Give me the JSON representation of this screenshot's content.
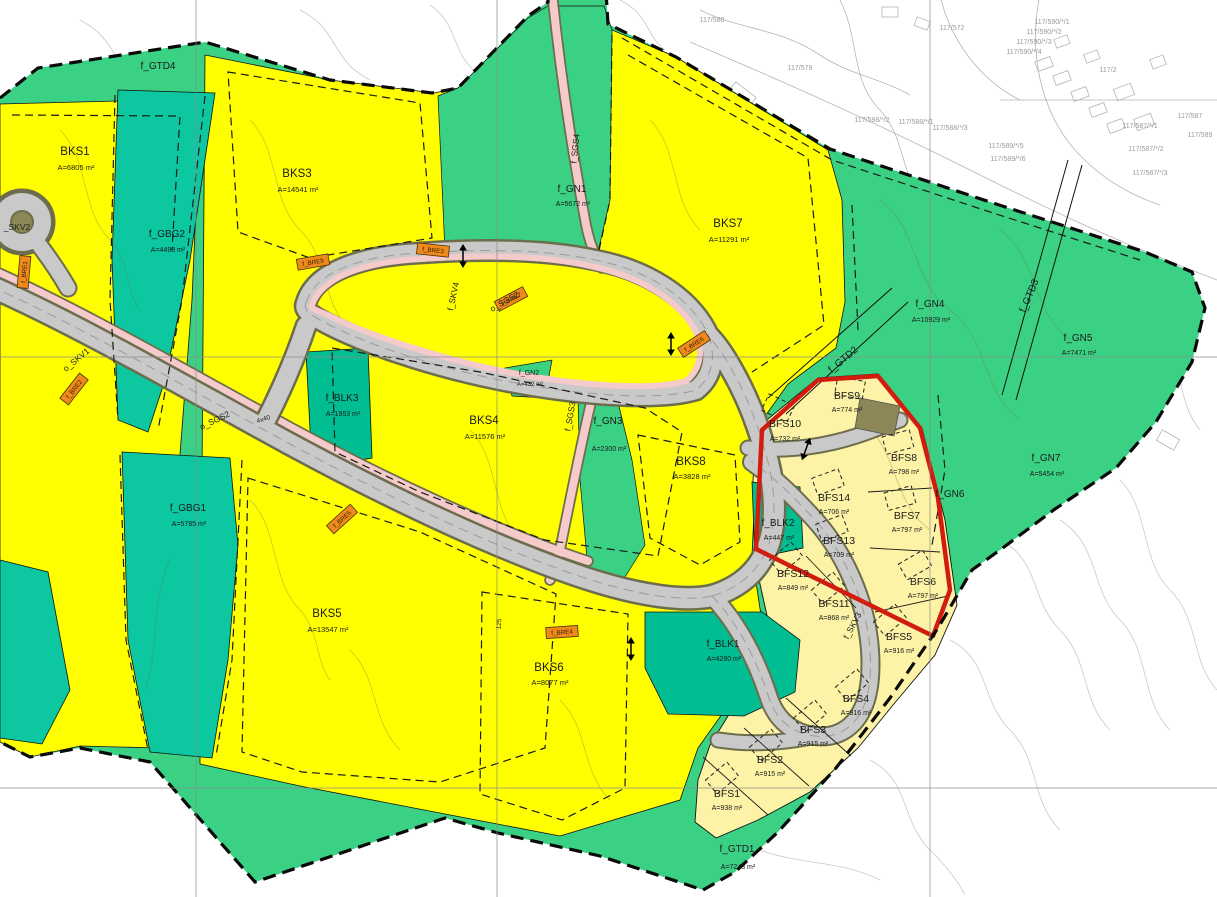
{
  "map": {
    "type": "zoning-plan-map",
    "colors": {
      "green_nature": "#3bd184",
      "teal_green_structure": "#0cc7a0",
      "teal_play_area": "#00bd92",
      "yellow_housing": "#ffff00",
      "pale_yellow_housing": "#fdf3a6",
      "road_gray": "#c9c9c9",
      "road_edge_olive": "#6d6d4d",
      "walkway_pink": "#f5caca",
      "highlight_red": "#d21c10",
      "marker_orange": "#ee8a1c"
    },
    "labels": {
      "bks1": {
        "n": "BKS1",
        "a": "A=6805 m²"
      },
      "bks3": {
        "n": "BKS3",
        "a": "A=14541 m²"
      },
      "bks4": {
        "n": "BKS4",
        "a": "A=11576 m²"
      },
      "bks5": {
        "n": "BKS5",
        "a": "A=13547 m²"
      },
      "bks6": {
        "n": "BKS6",
        "a": "A=8077 m²"
      },
      "bks7": {
        "n": "BKS7",
        "a": "A=11291 m²"
      },
      "bks8": {
        "n": "BKS8",
        "a": "A=3828 m²"
      },
      "bfs1": {
        "n": "BFS1",
        "a": "A=938 m²"
      },
      "bfs2": {
        "n": "BFS2",
        "a": "A=915 m²"
      },
      "bfs3": {
        "n": "BFS3",
        "a": "A=915 m²"
      },
      "bfs4": {
        "n": "BFS4",
        "a": "A=916 m²"
      },
      "bfs5": {
        "n": "BFS5",
        "a": "A=916 m²"
      },
      "bfs6": {
        "n": "BFS6",
        "a": "A=797 m²"
      },
      "bfs7": {
        "n": "BFS7",
        "a": "A=797 m²"
      },
      "bfs8": {
        "n": "BFS8",
        "a": "A=798 m²"
      },
      "bfs9": {
        "n": "BFS9",
        "a": "A=774 m²"
      },
      "bfs10": {
        "n": "BFS10",
        "a": "A=732 m²"
      },
      "bfs11": {
        "n": "BFS11",
        "a": "A=868 m²"
      },
      "bfs12": {
        "n": "BFS12",
        "a": "A=849 m²"
      },
      "bfs13": {
        "n": "BFS13",
        "a": "A=709 m²"
      },
      "bfs14": {
        "n": "BFS14",
        "a": "A=706 m²"
      },
      "gn1": {
        "n": "f_GN1",
        "a": "A=5672 m²"
      },
      "gn2": {
        "n": "f_GN2",
        "a": "A=432 m²"
      },
      "gn3": {
        "n": "f_GN3",
        "a": "A=2300 m²"
      },
      "gn4": {
        "n": "f_GN4",
        "a": "A=10929 m²"
      },
      "gn5": {
        "n": "f_GN5",
        "a": "A=7471 m²"
      },
      "gn6": {
        "n": "f_GN6",
        "a": ""
      },
      "gn7": {
        "n": "f_GN7",
        "a": "A=5454 m²"
      },
      "gbg1": {
        "n": "f_GBG1",
        "a": "A=5785 m²"
      },
      "gbg2": {
        "n": "f_GBG2",
        "a": "A=4498 m²"
      },
      "blk1": {
        "n": "f_BLK1",
        "a": "A=4280 m²"
      },
      "blk2": {
        "n": "f_BLK2",
        "a": "A=447 m²"
      },
      "blk3": {
        "n": "f_BLK3",
        "a": "A=1953 m²"
      },
      "gtd1": {
        "n": "f_GTD1",
        "a": "A=7243 m²"
      },
      "gtd2": {
        "n": "f_GTD2",
        "a": ""
      },
      "gtd3": {
        "n": "f_GTD3",
        "a": ""
      },
      "gtd4": {
        "n": "f_GTD4",
        "a": ""
      }
    },
    "roads": {
      "skv1": "o_SKV1",
      "skv2": "_SKV2",
      "skv3": "f_SKV3",
      "skv4": "f_SKV4",
      "sgs2": "o_SGS2",
      "sgs3": "f_SGS3",
      "sgs4": "f_SGS4"
    },
    "bre_markers": {
      "b1": "f_BRE1",
      "b2": "f_BRE2",
      "b3": "f_BRE3",
      "b4": "f_BRE4",
      "b5": "f_BRE5",
      "b6": "f_BRE6",
      "b7": "f_BRE7",
      "b9": "f_BRE9"
    },
    "dimensions": {
      "d1": "4x40",
      "d2": "125"
    },
    "cadastral": [
      "117/580",
      "117/579",
      "117/572",
      "117/590/*/1",
      "117/590/*/2",
      "117/590/*/3",
      "117/590/*/4",
      "117/2",
      "117/587",
      "117/587/*/1",
      "117/587/*/2",
      "117/587/*/3",
      "117/589",
      "117/589/*/5",
      "117/589/*/6",
      "117/588/*/1",
      "117/588/*/2",
      "117/588/*/3"
    ]
  }
}
